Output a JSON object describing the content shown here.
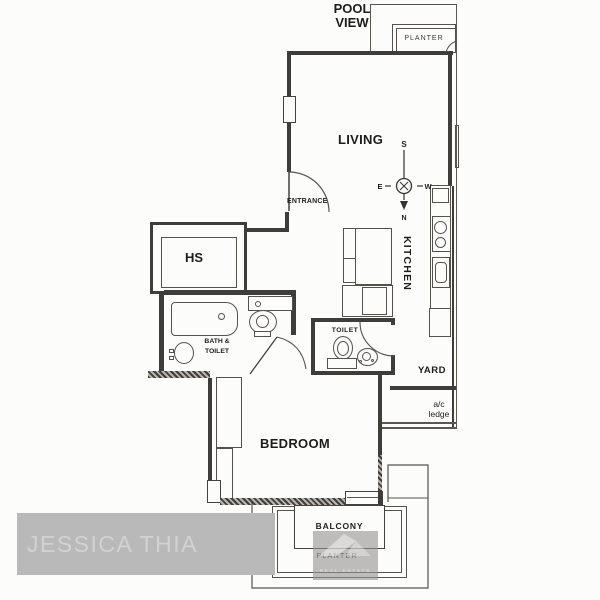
{
  "colors": {
    "background": "#fcfcfb",
    "wall": "#3f3d3a",
    "label_text": "#1d1d1b",
    "watermark_box": "#b9b9b9",
    "watermark_text": "#d2d2d2"
  },
  "pool_view": {
    "line1": "POOL",
    "line2": "VIEW"
  },
  "planter_top": "PLANTER",
  "rooms": {
    "living": "LIVING",
    "entrance": "ENTRANCE",
    "hs": "HS",
    "kitchen": "KITCHEN",
    "bath_toilet": {
      "line1": "BATH &",
      "line2": "TOILET"
    },
    "toilet": "TOILET",
    "yard": "YARD",
    "ac_ledge": {
      "line1": "a/c",
      "line2": "ledge"
    },
    "bedroom": "BEDROOM",
    "balcony": "BALCONY",
    "planter": "PLANTER"
  },
  "compass": {
    "top": "S",
    "left": "E",
    "right": "W",
    "bottom": "N"
  },
  "watermark": {
    "agent": "JESSICA THIA",
    "brand": "REAL ESTATE"
  }
}
